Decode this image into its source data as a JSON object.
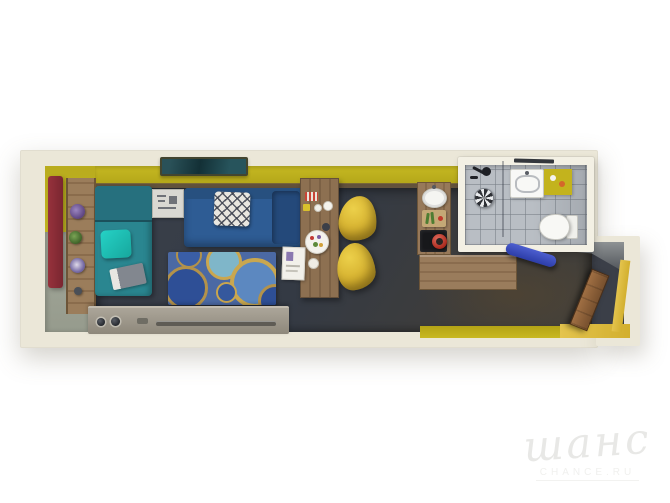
{
  "watermark": {
    "brand": "шанс",
    "domain": "CHANCE.RU"
  },
  "colors": {
    "bg": "#ffffff",
    "wall": "#ebe7d8",
    "accent-yellow": "#bfb21e",
    "floor-dark": "#3a404b",
    "floor-left-green": "#9da294",
    "curtain-red": "#8e2e38",
    "wood": "#8b6e4f",
    "sofa-teal": "#2a8690",
    "pillow-teal": "#1ec0b6",
    "sofa-blue": "#2e5c94",
    "rug": "#4b69a4",
    "sideboard": "#9c968a",
    "chair-yellow": "#d6b52e",
    "cooktop-black": "#17181b",
    "pot-red": "#c03127",
    "tile": "#b9bec4",
    "bath-wall": "#f3f0e4",
    "bench-blue": "#3a4ec0",
    "watermark": "#e8e8e6"
  }
}
